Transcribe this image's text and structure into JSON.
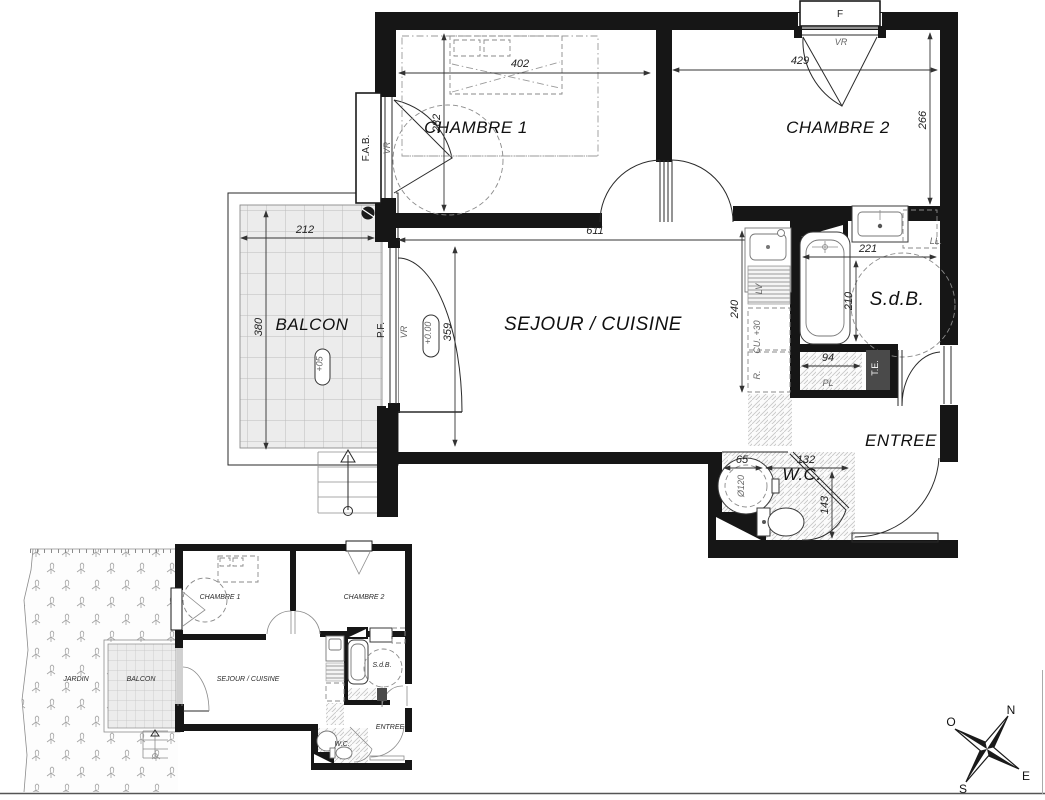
{
  "main_plan": {
    "rooms": {
      "chambre1": "CHAMBRE 1",
      "chambre2": "CHAMBRE 2",
      "sejour": "SEJOUR / CUISINE",
      "balcon": "BALCON",
      "sdb": "S.d.B.",
      "entree": "ENTREE",
      "wc": "W.C."
    },
    "dims": {
      "chambre1_w": "402",
      "chambre1_h": "282",
      "chambre2_w": "429",
      "chambre2_h": "266",
      "sejour_w": "611",
      "sejour_h": "359",
      "kitchen_h": "240",
      "balcon_w": "212",
      "balcon_h": "380",
      "sdb_w": "221",
      "sdb_h": "210",
      "closet_w": "94",
      "wc_w1": "65",
      "wc_w2": "132",
      "wc_h": "143"
    },
    "labels": {
      "window": "F",
      "shutter": "VR",
      "window_left": "F.A.B.",
      "french_door": "P.F.",
      "level_floor": "+0.00",
      "level_balcony": "+05",
      "washing_machine": "LL.",
      "electrical_panel": "T.E.",
      "closet": "PL",
      "counter": "CU. +30",
      "fridge": "R.",
      "dishwasher": "LV",
      "water_heater": "Ø120"
    }
  },
  "mini_plan": {
    "jardin": "JARDIN",
    "balcon": "BALCON",
    "chambre1": "CHAMBRE 1",
    "chambre2": "CHAMBRE 2",
    "sejour": "SEJOUR / CUISINE",
    "sdb": "S.d.B.",
    "entree": "ENTREE",
    "wc": "W.C."
  },
  "compass": {
    "north": "N",
    "east": "E",
    "south": "S",
    "west": "O"
  }
}
